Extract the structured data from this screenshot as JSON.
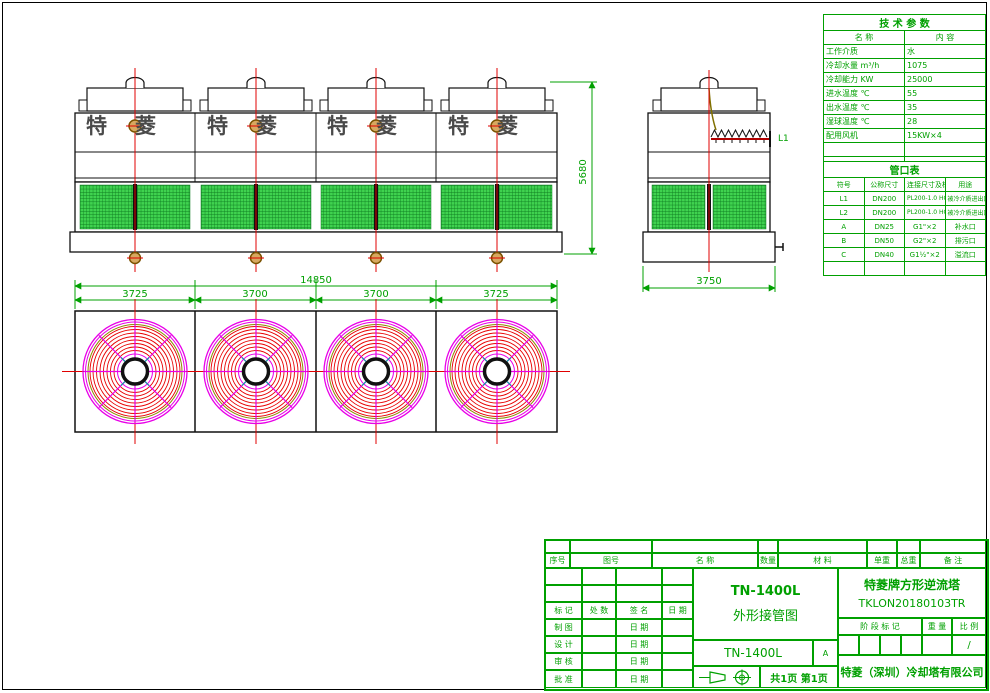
{
  "colors": {
    "line_green": "#00a000",
    "centerline_red": "#e00000",
    "fan_magenta": "#e800e8",
    "fan_red": "#e80000",
    "louver_green": "#3fd24f",
    "brand_gray": "#4a4a4a"
  },
  "views": {
    "front": {
      "brand": "特菱"
    },
    "side": {
      "pipe_label": "L1"
    },
    "dims": {
      "overall_height": "5680",
      "side_width": "3750",
      "plan_total": "14850",
      "plan_segments": [
        "3725",
        "3700",
        "3700",
        "3725"
      ]
    }
  },
  "tech_table": {
    "title": "技 术 参 数",
    "headers": {
      "name": "名  称",
      "value": "内  容"
    },
    "rows": [
      {
        "name": "工作介质",
        "value": "水"
      },
      {
        "name": "冷却水量 m³/h",
        "value": "1075"
      },
      {
        "name": "冷却能力 KW",
        "value": "25000"
      },
      {
        "name": "进水温度 ℃",
        "value": "55"
      },
      {
        "name": "出水温度 ℃",
        "value": "35"
      },
      {
        "name": "湿球温度 ℃",
        "value": "28"
      },
      {
        "name": "配用风机",
        "value": "15KW×4"
      },
      {
        "name": "",
        "value": ""
      },
      {
        "name": "",
        "value": ""
      }
    ]
  },
  "pipe_table": {
    "title": "管口表",
    "headers": [
      "符号",
      "公称尺寸",
      "连接尺寸及标准",
      "用途"
    ],
    "rows": [
      {
        "code": "L1",
        "size": "DN200",
        "conn": "PL200-1.0 HG20593",
        "use": "被冷介质进出口"
      },
      {
        "code": "L2",
        "size": "DN200",
        "conn": "PL200-1.0 HG20593",
        "use": "被冷介质进出口"
      },
      {
        "code": "A",
        "size": "DN25",
        "conn": "G1\"×2",
        "use": "补水口"
      },
      {
        "code": "B",
        "size": "DN50",
        "conn": "G2\"×2",
        "use": "排污口"
      },
      {
        "code": "C",
        "size": "DN40",
        "conn": "G1½\"×2",
        "use": "溢流口"
      },
      {
        "code": "",
        "size": "",
        "conn": "",
        "use": ""
      }
    ]
  },
  "title_block": {
    "parts_headers": [
      "序号",
      "图号",
      "名  称",
      "数量",
      "材  料",
      "单重",
      "总重",
      "备  注"
    ],
    "sign_headers": [
      "标 记",
      "处 数",
      "签  名",
      "日 期"
    ],
    "sign_rows": [
      {
        "label": "制 图",
        "date": "日 期"
      },
      {
        "label": "设 计",
        "date": "日 期"
      },
      {
        "label": "审 核",
        "date": "日 期"
      },
      {
        "label": "批 准",
        "date": "日 期"
      }
    ],
    "title_line1": "TN-1400L",
    "title_line2": "外形接管图",
    "model": "TN-1400L",
    "revision": "A",
    "page_info": "共1页 第1页",
    "product_name": "特菱牌方形逆流塔",
    "drawing_no": "TKLON20180103TR",
    "stage_label": "阶 段 标 记",
    "weight_label": "重 量",
    "scale_label": "比 例",
    "scale_value": "/",
    "company": "特菱（深圳）冷却塔有限公司"
  }
}
